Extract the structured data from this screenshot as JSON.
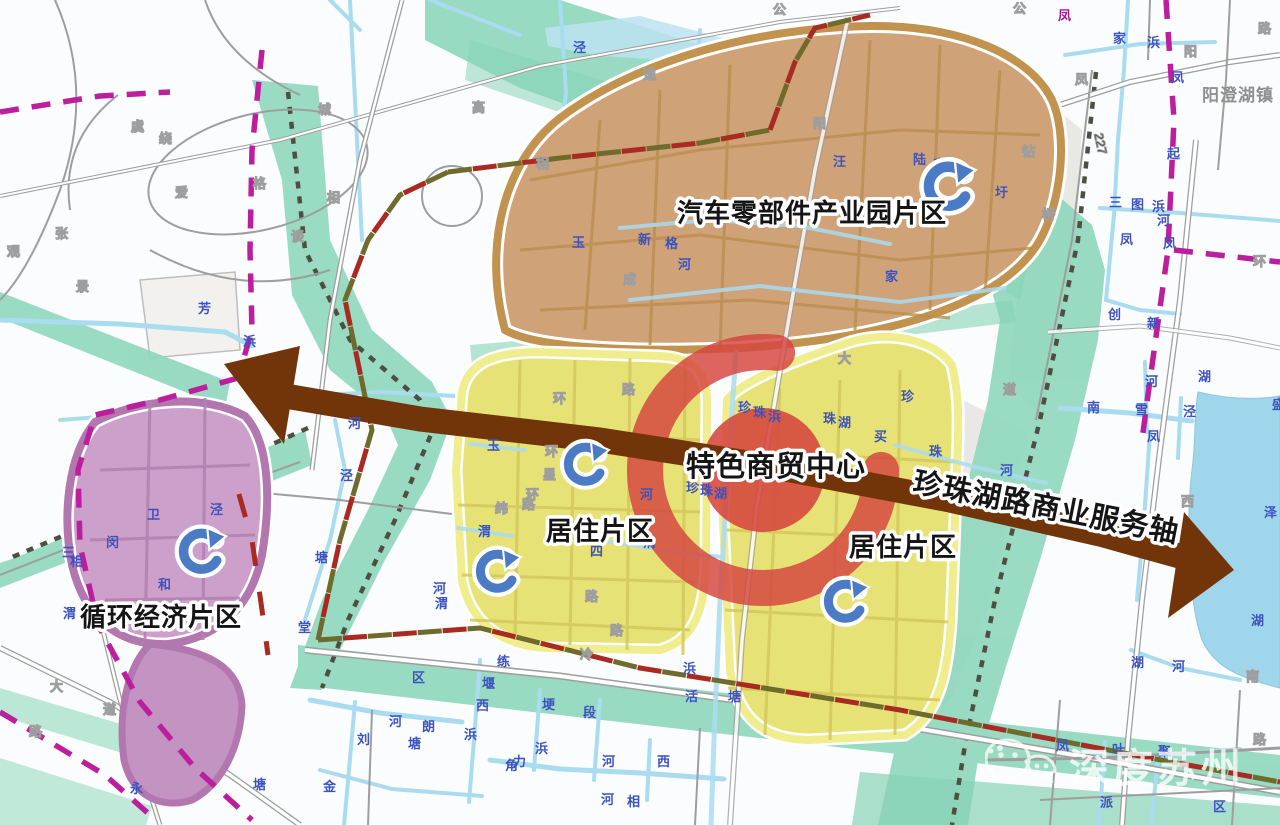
{
  "region_labels": {
    "industrial_park": "汽车零部件产业园片区",
    "residential_left": "居住片区",
    "residential_right": "居住片区",
    "circular_economy": "循环经济片区",
    "commerce_center": "特色商贸中心"
  },
  "axis_label": "珍珠湖路商业服务轴",
  "town_label": "阳澄湖镇",
  "road_number": "227",
  "watermark_text": "深度苏州",
  "colors": {
    "belt-green": "#8ED8BC",
    "belt-green2": "#7BCFAF",
    "water-blue": "#A9DCF0",
    "lake-blue": "#A0D6EC",
    "river-label": "#3C52BE",
    "boundary-magenta": "#BC1F9E",
    "boundary-darkred": "#A82A20",
    "industrial-fill": "#CFA278",
    "industrial-ring": "#C1934F",
    "residential-fill": "#E7E276",
    "residential-ring": "#F0ED8F",
    "circular-fill": "#CCA0CB",
    "circular-ring": "#B277AF",
    "ring-red": "#D5463E",
    "axis-brown": "#723509"
  },
  "recycle_icons": [
    {
      "x": 948,
      "y": 186,
      "s": 1.15
    },
    {
      "x": 585,
      "y": 464,
      "s": 1.0
    },
    {
      "x": 497,
      "y": 571,
      "s": 1.0
    },
    {
      "x": 845,
      "y": 601,
      "s": 1.0
    },
    {
      "x": 201,
      "y": 551,
      "s": 1.05
    }
  ],
  "map_annotations": [
    {
      "t": "泾",
      "x": 573,
      "y": 52,
      "c": "water"
    },
    {
      "t": "速",
      "x": 643,
      "y": 79,
      "c": "road"
    },
    {
      "t": "高",
      "x": 472,
      "y": 112,
      "c": "road"
    },
    {
      "t": "公",
      "x": 773,
      "y": 14,
      "c": "road"
    },
    {
      "t": "公",
      "x": 1013,
      "y": 13,
      "c": "road"
    },
    {
      "t": "路",
      "x": 1258,
      "y": 33,
      "c": "road"
    },
    {
      "t": "凤",
      "x": 1058,
      "y": 20,
      "c": "boundary"
    },
    {
      "t": "家",
      "x": 1113,
      "y": 43,
      "c": "water"
    },
    {
      "t": "浜",
      "x": 1147,
      "y": 47,
      "c": "water"
    },
    {
      "t": "阳",
      "x": 1184,
      "y": 56,
      "c": "road"
    },
    {
      "t": "凤",
      "x": 1075,
      "y": 84,
      "c": "road"
    },
    {
      "t": "凤",
      "x": 1171,
      "y": 82,
      "c": "water"
    },
    {
      "t": "城",
      "x": 318,
      "y": 114,
      "c": "road"
    },
    {
      "t": "虞",
      "x": 131,
      "y": 131,
      "c": "road"
    },
    {
      "t": "绕",
      "x": 159,
      "y": 143,
      "c": "road"
    },
    {
      "t": "张",
      "x": 55,
      "y": 238,
      "c": "road"
    },
    {
      "t": "观",
      "x": 7,
      "y": 256,
      "c": "road"
    },
    {
      "t": "景",
      "x": 76,
      "y": 291,
      "c": "road"
    },
    {
      "t": "爱",
      "x": 175,
      "y": 197,
      "c": "road"
    },
    {
      "t": "格",
      "x": 253,
      "y": 188,
      "c": "road"
    },
    {
      "t": "相",
      "x": 327,
      "y": 202,
      "c": "road"
    },
    {
      "t": "谈",
      "x": 291,
      "y": 241,
      "c": "road"
    },
    {
      "t": "相",
      "x": 536,
      "y": 168,
      "c": "road"
    },
    {
      "t": "阳",
      "x": 813,
      "y": 128,
      "c": "road"
    },
    {
      "t": "汪",
      "x": 833,
      "y": 166,
      "c": "water"
    },
    {
      "t": "陆",
      "x": 913,
      "y": 164,
      "c": "water"
    },
    {
      "t": "家",
      "x": 933,
      "y": 169,
      "c": "water"
    },
    {
      "t": "钻",
      "x": 1022,
      "y": 156,
      "c": "road"
    },
    {
      "t": "圩",
      "x": 995,
      "y": 197,
      "c": "water"
    },
    {
      "t": "桥",
      "x": 1042,
      "y": 219,
      "c": "road"
    },
    {
      "t": "新",
      "x": 638,
      "y": 244,
      "c": "water"
    },
    {
      "t": "格",
      "x": 665,
      "y": 248,
      "c": "water"
    },
    {
      "t": "河",
      "x": 678,
      "y": 269,
      "c": "water"
    },
    {
      "t": "成",
      "x": 623,
      "y": 284,
      "c": "road"
    },
    {
      "t": "家",
      "x": 885,
      "y": 281,
      "c": "water"
    },
    {
      "t": "玉",
      "x": 572,
      "y": 247,
      "c": "water"
    },
    {
      "t": "起",
      "x": 1167,
      "y": 158,
      "c": "water"
    },
    {
      "t": "三",
      "x": 1109,
      "y": 207,
      "c": "water"
    },
    {
      "t": "图",
      "x": 1131,
      "y": 209,
      "c": "water"
    },
    {
      "t": "浜",
      "x": 1152,
      "y": 211,
      "c": "water"
    },
    {
      "t": "河",
      "x": 1157,
      "y": 225,
      "c": "water"
    },
    {
      "t": "凤",
      "x": 1163,
      "y": 248,
      "c": "water"
    },
    {
      "t": "环",
      "x": 1253,
      "y": 266,
      "c": "road"
    },
    {
      "t": "凤",
      "x": 1120,
      "y": 244,
      "c": "water"
    },
    {
      "t": "创",
      "x": 1108,
      "y": 319,
      "c": "water"
    },
    {
      "t": "新",
      "x": 1147,
      "y": 328,
      "c": "water"
    },
    {
      "t": "湖",
      "x": 1198,
      "y": 381,
      "c": "water"
    },
    {
      "t": "河",
      "x": 1145,
      "y": 386,
      "c": "water"
    },
    {
      "t": "南",
      "x": 1087,
      "y": 412,
      "c": "water"
    },
    {
      "t": "雪",
      "x": 1135,
      "y": 414,
      "c": "water"
    },
    {
      "t": "泾",
      "x": 1183,
      "y": 416,
      "c": "water"
    },
    {
      "t": "凤",
      "x": 1147,
      "y": 441,
      "c": "water"
    },
    {
      "t": "盛",
      "x": 1272,
      "y": 409,
      "c": "water"
    },
    {
      "t": "泽",
      "x": 1264,
      "y": 517,
      "c": "water"
    },
    {
      "t": "湖",
      "x": 1251,
      "y": 625,
      "c": "water"
    },
    {
      "t": "西",
      "x": 1181,
      "y": 506,
      "c": "road"
    },
    {
      "t": "珍",
      "x": 738,
      "y": 412,
      "c": "water"
    },
    {
      "t": "珠",
      "x": 753,
      "y": 417,
      "c": "water"
    },
    {
      "t": "浜",
      "x": 768,
      "y": 421,
      "c": "water"
    },
    {
      "t": "珠",
      "x": 823,
      "y": 423,
      "c": "water"
    },
    {
      "t": "湖",
      "x": 838,
      "y": 427,
      "c": "water"
    },
    {
      "t": "买",
      "x": 874,
      "y": 441,
      "c": "water"
    },
    {
      "t": "珍",
      "x": 901,
      "y": 401,
      "c": "water"
    },
    {
      "t": "珠",
      "x": 929,
      "y": 456,
      "c": "water"
    },
    {
      "t": "河",
      "x": 1000,
      "y": 475,
      "c": "water"
    },
    {
      "t": "大",
      "x": 838,
      "y": 363,
      "c": "road"
    },
    {
      "t": "道",
      "x": 1003,
      "y": 394,
      "c": "road"
    },
    {
      "t": "珍",
      "x": 686,
      "y": 492,
      "c": "water"
    },
    {
      "t": "珠",
      "x": 700,
      "y": 495,
      "c": "water"
    },
    {
      "t": "湖",
      "x": 714,
      "y": 498,
      "c": "water"
    },
    {
      "t": "渭",
      "x": 643,
      "y": 547,
      "c": "water"
    },
    {
      "t": "玉",
      "x": 487,
      "y": 450,
      "c": "water"
    },
    {
      "t": "渭",
      "x": 478,
      "y": 536,
      "c": "water"
    },
    {
      "t": "河",
      "x": 640,
      "y": 499,
      "c": "water"
    },
    {
      "t": "四",
      "x": 590,
      "y": 556,
      "c": "water"
    },
    {
      "t": "环",
      "x": 553,
      "y": 403,
      "c": "road"
    },
    {
      "t": "路",
      "x": 622,
      "y": 394,
      "c": "road"
    },
    {
      "t": "环",
      "x": 545,
      "y": 456,
      "c": "road"
    },
    {
      "t": "星",
      "x": 543,
      "y": 479,
      "c": "road"
    },
    {
      "t": "环",
      "x": 526,
      "y": 499,
      "c": "road"
    },
    {
      "t": "路",
      "x": 522,
      "y": 509,
      "c": "road"
    },
    {
      "t": "纬",
      "x": 495,
      "y": 513,
      "c": "road"
    },
    {
      "t": "路",
      "x": 585,
      "y": 601,
      "c": "road"
    },
    {
      "t": "河",
      "x": 348,
      "y": 428,
      "c": "water"
    },
    {
      "t": "泾",
      "x": 340,
      "y": 480,
      "c": "water"
    },
    {
      "t": "塘",
      "x": 315,
      "y": 562,
      "c": "water"
    },
    {
      "t": "堂",
      "x": 298,
      "y": 632,
      "c": "water"
    },
    {
      "t": "河",
      "x": 433,
      "y": 593,
      "c": "water"
    },
    {
      "t": "渭",
      "x": 435,
      "y": 608,
      "c": "water"
    },
    {
      "t": "浜",
      "x": 243,
      "y": 346,
      "c": "water"
    },
    {
      "t": "芳",
      "x": 198,
      "y": 313,
      "c": "water"
    },
    {
      "t": "卫",
      "x": 147,
      "y": 519,
      "c": "water"
    },
    {
      "t": "闵",
      "x": 106,
      "y": 547,
      "c": "water"
    },
    {
      "t": "三",
      "x": 62,
      "y": 557,
      "c": "water"
    },
    {
      "t": "相",
      "x": 70,
      "y": 566,
      "c": "water"
    },
    {
      "t": "和",
      "x": 158,
      "y": 589,
      "c": "water"
    },
    {
      "t": "泾",
      "x": 210,
      "y": 514,
      "c": "water"
    },
    {
      "t": "渭",
      "x": 63,
      "y": 618,
      "c": "water"
    },
    {
      "t": "大",
      "x": 50,
      "y": 691,
      "c": "road"
    },
    {
      "t": "道",
      "x": 103,
      "y": 714,
      "c": "road"
    },
    {
      "t": "路",
      "x": 29,
      "y": 736,
      "c": "road"
    },
    {
      "t": "永",
      "x": 130,
      "y": 793,
      "c": "water"
    },
    {
      "t": "塘",
      "x": 253,
      "y": 789,
      "c": "water"
    },
    {
      "t": "区",
      "x": 412,
      "y": 682,
      "c": "water"
    },
    {
      "t": "河",
      "x": 389,
      "y": 726,
      "c": "water"
    },
    {
      "t": "塘",
      "x": 408,
      "y": 748,
      "c": "water"
    },
    {
      "t": "刘",
      "x": 357,
      "y": 744,
      "c": "water"
    },
    {
      "t": "金",
      "x": 323,
      "y": 791,
      "c": "water"
    },
    {
      "t": "朗",
      "x": 422,
      "y": 731,
      "c": "water"
    },
    {
      "t": "浜",
      "x": 464,
      "y": 739,
      "c": "water"
    },
    {
      "t": "练",
      "x": 497,
      "y": 666,
      "c": "water"
    },
    {
      "t": "堰",
      "x": 482,
      "y": 688,
      "c": "water"
    },
    {
      "t": "西",
      "x": 476,
      "y": 710,
      "c": "water"
    },
    {
      "t": "冷",
      "x": 580,
      "y": 659,
      "c": "road"
    },
    {
      "t": "路",
      "x": 610,
      "y": 635,
      "c": "road"
    },
    {
      "t": "力",
      "x": 513,
      "y": 766,
      "c": "water"
    },
    {
      "t": "角",
      "x": 505,
      "y": 770,
      "c": "water"
    },
    {
      "t": "埂",
      "x": 542,
      "y": 709,
      "c": "water"
    },
    {
      "t": "浜",
      "x": 535,
      "y": 753,
      "c": "water"
    },
    {
      "t": "段",
      "x": 583,
      "y": 717,
      "c": "water"
    },
    {
      "t": "河",
      "x": 602,
      "y": 766,
      "c": "water"
    },
    {
      "t": "西",
      "x": 657,
      "y": 766,
      "c": "water"
    },
    {
      "t": "河",
      "x": 601,
      "y": 804,
      "c": "water"
    },
    {
      "t": "相",
      "x": 627,
      "y": 806,
      "c": "water"
    },
    {
      "t": "浜",
      "x": 683,
      "y": 673,
      "c": "water"
    },
    {
      "t": "活",
      "x": 685,
      "y": 701,
      "c": "water"
    },
    {
      "t": "塘",
      "x": 728,
      "y": 701,
      "c": "water"
    },
    {
      "t": "凤",
      "x": 1056,
      "y": 750,
      "c": "water"
    },
    {
      "t": "叶",
      "x": 1112,
      "y": 754,
      "c": "water"
    },
    {
      "t": "聚",
      "x": 1158,
      "y": 756,
      "c": "water"
    },
    {
      "t": "路",
      "x": 1253,
      "y": 744,
      "c": "road"
    },
    {
      "t": "派",
      "x": 1100,
      "y": 807,
      "c": "water"
    },
    {
      "t": "区",
      "x": 1213,
      "y": 811,
      "c": "water"
    },
    {
      "t": "河",
      "x": 1172,
      "y": 671,
      "c": "water"
    },
    {
      "t": "湖",
      "x": 1131,
      "y": 667,
      "c": "water"
    },
    {
      "t": "南",
      "x": 1246,
      "y": 681,
      "c": "road"
    }
  ]
}
